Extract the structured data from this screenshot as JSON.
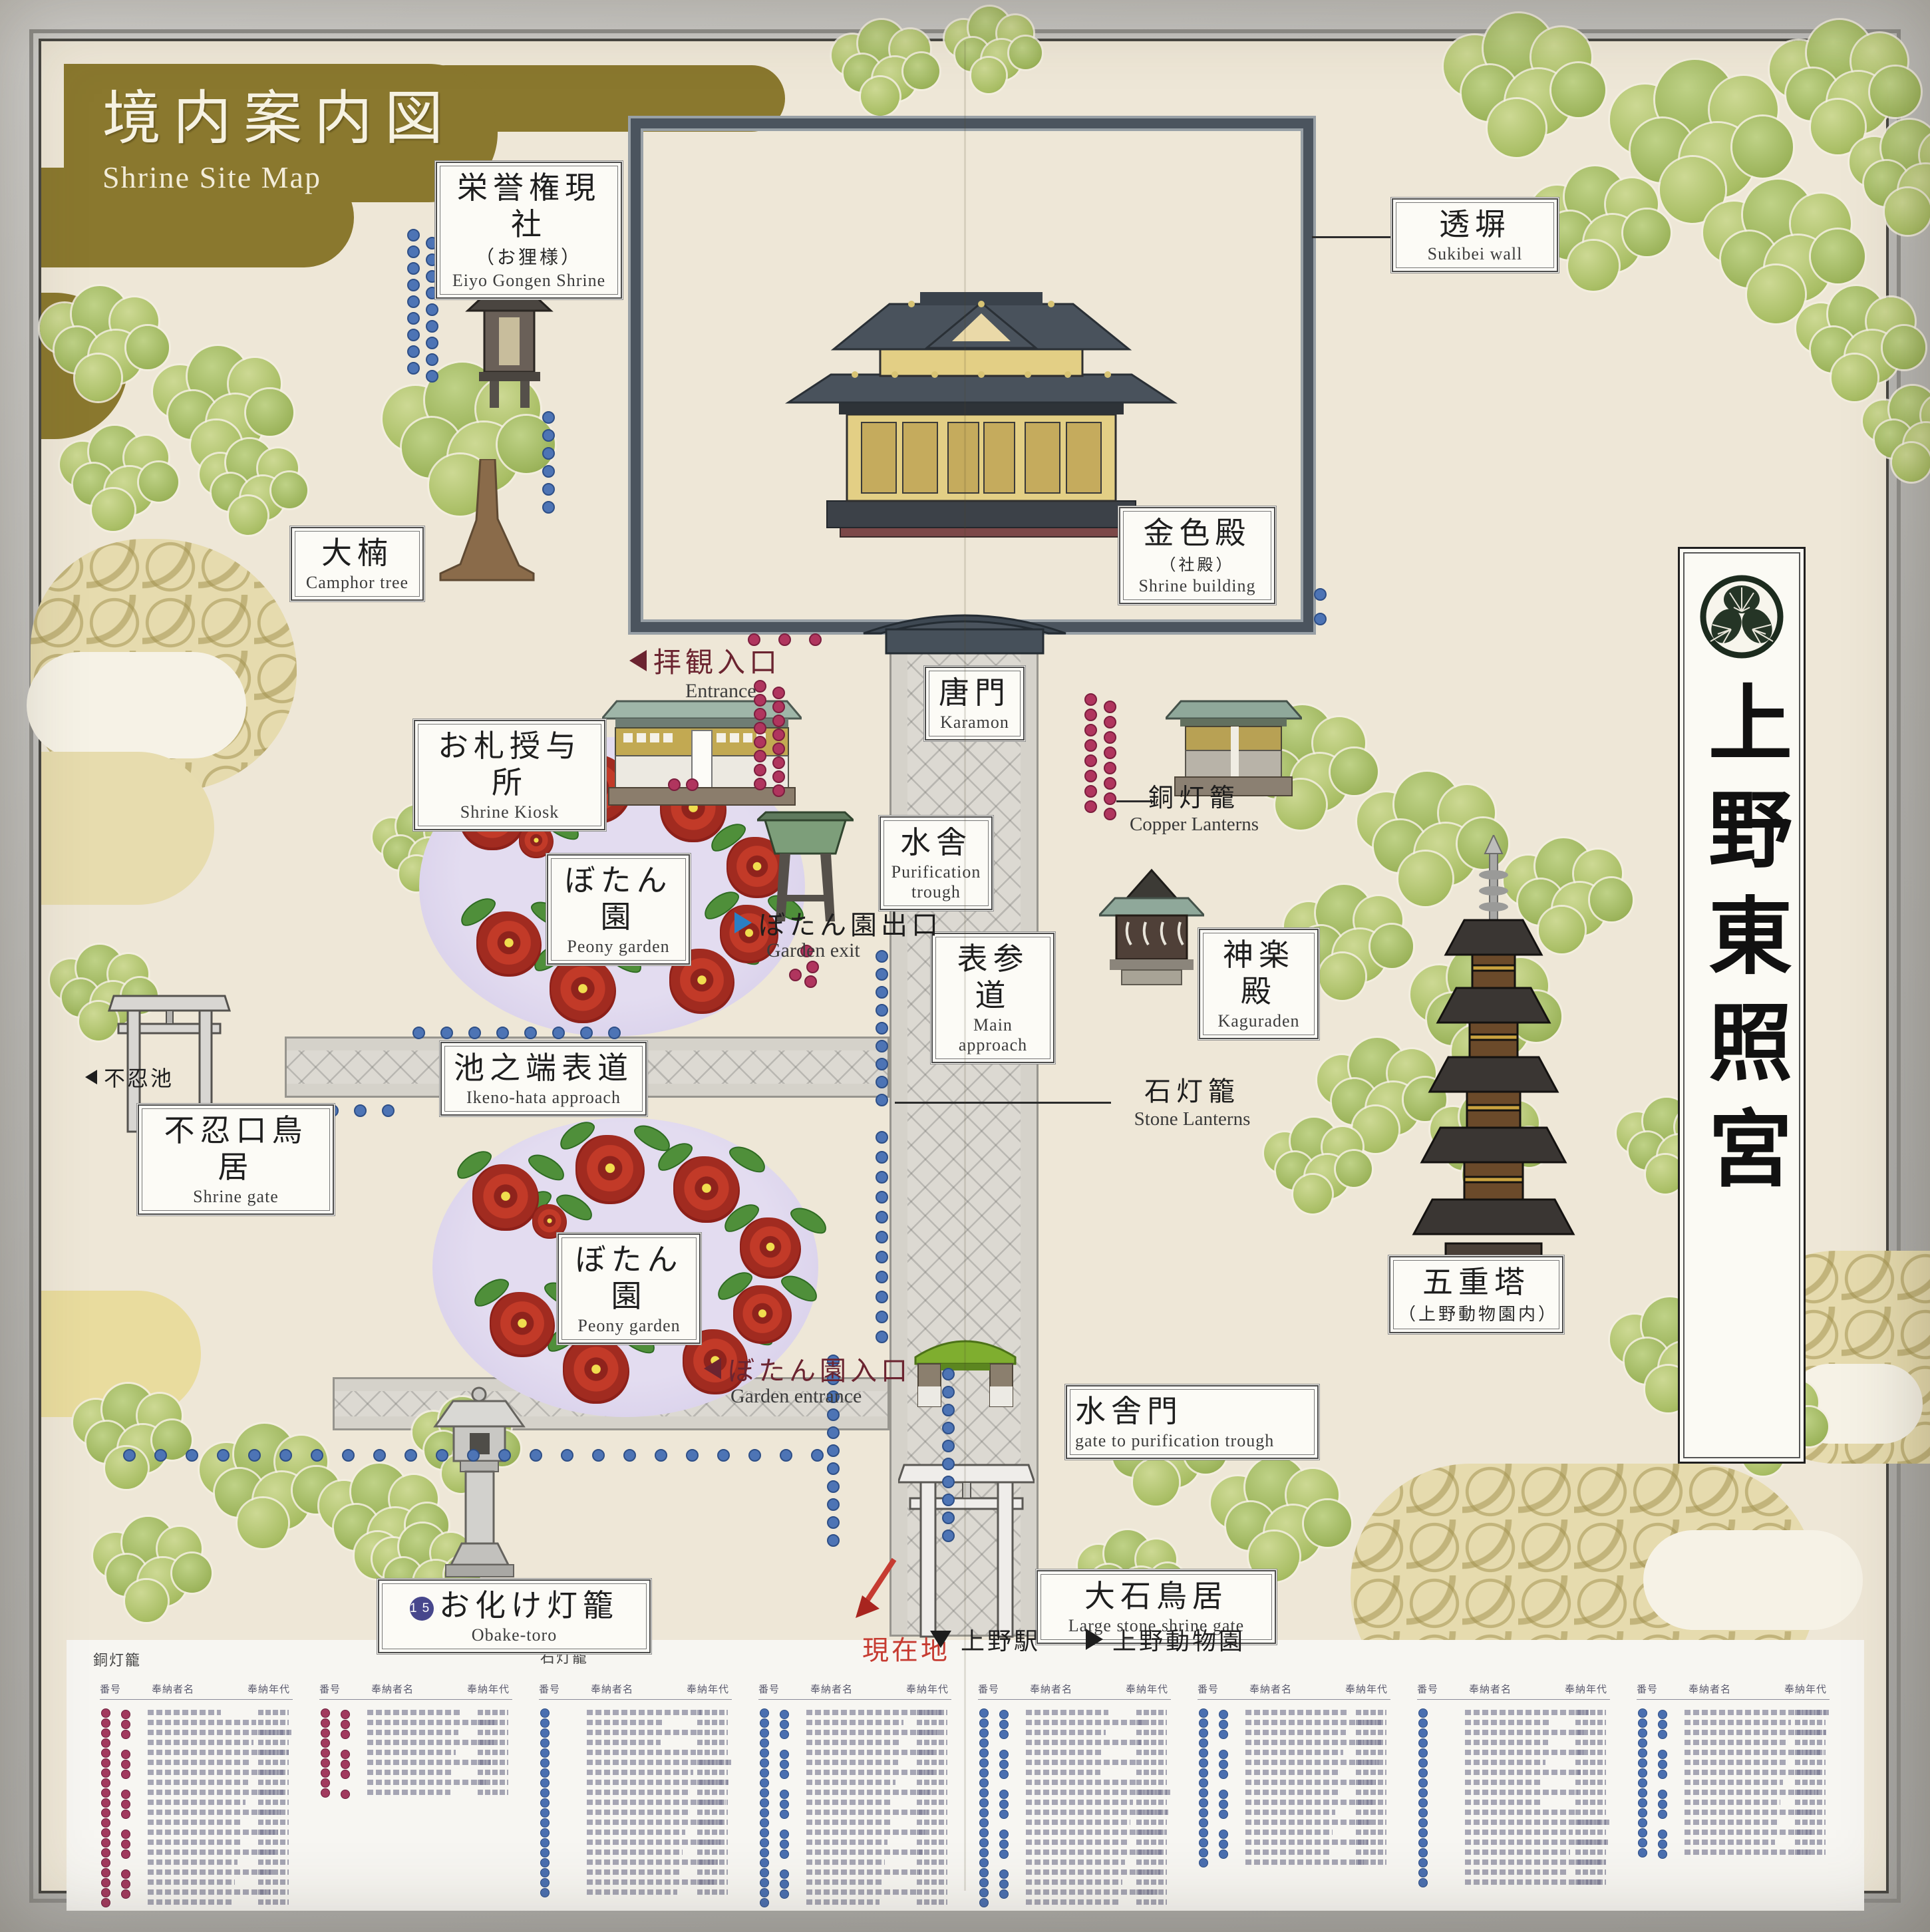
{
  "sign": {
    "title_jp": "境内案内図",
    "title_en": "Shrine Site Map"
  },
  "side_banner": {
    "text": "上野東照宮",
    "crest": "tokugawa-mitsuba-aoi"
  },
  "labels": {
    "eiyo": {
      "jp": "栄誉権現社",
      "sub": "（お狸様）",
      "en": "Eiyo Gongen Shrine"
    },
    "sukibei": {
      "jp": "透塀",
      "en": "Sukibei wall"
    },
    "camphor": {
      "jp": "大楠",
      "en": "Camphor tree"
    },
    "gold_hall": {
      "jp": "金色殿",
      "sub": "（社殿）",
      "en": "Shrine building"
    },
    "kiosk": {
      "jp": "お札授与所",
      "en": "Shrine Kiosk"
    },
    "karamon": {
      "jp": "唐門",
      "en": "Karamon"
    },
    "trough": {
      "jp": "水舎",
      "en": "Purification trough"
    },
    "approach": {
      "jp": "表参道",
      "en": "Main approach"
    },
    "kaguraden": {
      "jp": "神楽殿",
      "en": "Kaguraden"
    },
    "ikenohata": {
      "jp": "池之端表道",
      "en": "Ikeno-hata approach"
    },
    "shinobazu_gate": {
      "jp": "不忍口鳥居",
      "en": "Shrine gate"
    },
    "peony": {
      "jp": "ぼたん園",
      "en": "Peony garden"
    },
    "pagoda": {
      "jp": "五重塔",
      "sub": "（上野動物園内）"
    },
    "mizushamon": {
      "jp": "水舎門",
      "en": "gate to purification trough"
    },
    "big_torii": {
      "jp": "大石鳥居",
      "en": "Large stone shrine gate"
    },
    "obake": {
      "jp": "お化け灯籠",
      "en": "Obake-toro",
      "badge": "151"
    }
  },
  "markers": {
    "entrance": {
      "jp": "拝観入口",
      "en": "Entrance"
    },
    "garden_exit": {
      "jp": "ぼたん園出口",
      "en": "Garden exit"
    },
    "garden_entrance": {
      "jp": "ぼたん園入口",
      "en": "Garden entrance"
    },
    "pond": {
      "jp": "不忍池"
    },
    "copper_lanterns": {
      "jp": "銅灯籠",
      "en": "Copper Lanterns"
    },
    "stone_lanterns": {
      "jp": "石灯籠",
      "en": "Stone Lanterns"
    },
    "current_location": {
      "jp": "現在地"
    },
    "to_station": {
      "jp": "上野駅"
    },
    "to_zoo": {
      "jp": "上野動物園"
    }
  },
  "legend": {
    "copper_title": "銅灯籠",
    "stone_title": "石灯籠",
    "headers": {
      "no": "番号",
      "name": "奉納者名",
      "era": "奉納年代"
    },
    "groups": [
      {
        "type": "copper",
        "dot_cols": 2,
        "rows": 20
      },
      {
        "type": "copper",
        "dot_cols": 2,
        "rows": 9
      },
      {
        "type": "stone",
        "dot_cols": 1,
        "rows": 19
      },
      {
        "type": "stone",
        "dot_cols": 2,
        "rows": 20
      },
      {
        "type": "stone",
        "dot_cols": 2,
        "rows": 20
      },
      {
        "type": "stone",
        "dot_cols": 2,
        "rows": 16
      },
      {
        "type": "stone",
        "dot_cols": 1,
        "rows": 18
      },
      {
        "type": "stone",
        "dot_cols": 2,
        "rows": 15
      }
    ]
  },
  "colors": {
    "panel_cream": "#eee7d7",
    "banner_olive": "#8a782e",
    "copper_dot": "#b0355e",
    "stone_dot": "#4d74b5",
    "wall_slate": "#4b545e",
    "accent_red": "#c63b31"
  }
}
